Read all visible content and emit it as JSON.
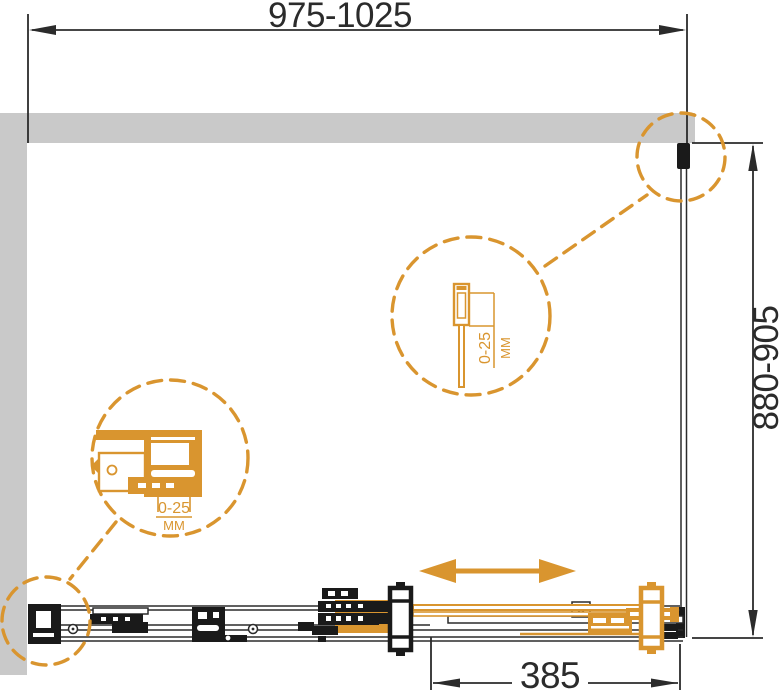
{
  "colors": {
    "accent": "#D9952F",
    "wall": "#C9C9C9",
    "ink": "#2B2B2B",
    "black": "#1A1A1A",
    "bg": "#FFFFFF"
  },
  "dimensions": {
    "width": "975-1025",
    "depth": "880-905",
    "door_travel": "385"
  },
  "callouts": {
    "wall_profile": {
      "range": "0-25",
      "unit": "MM"
    },
    "bottom_track": {
      "range": "0-25",
      "unit": "MM"
    }
  }
}
